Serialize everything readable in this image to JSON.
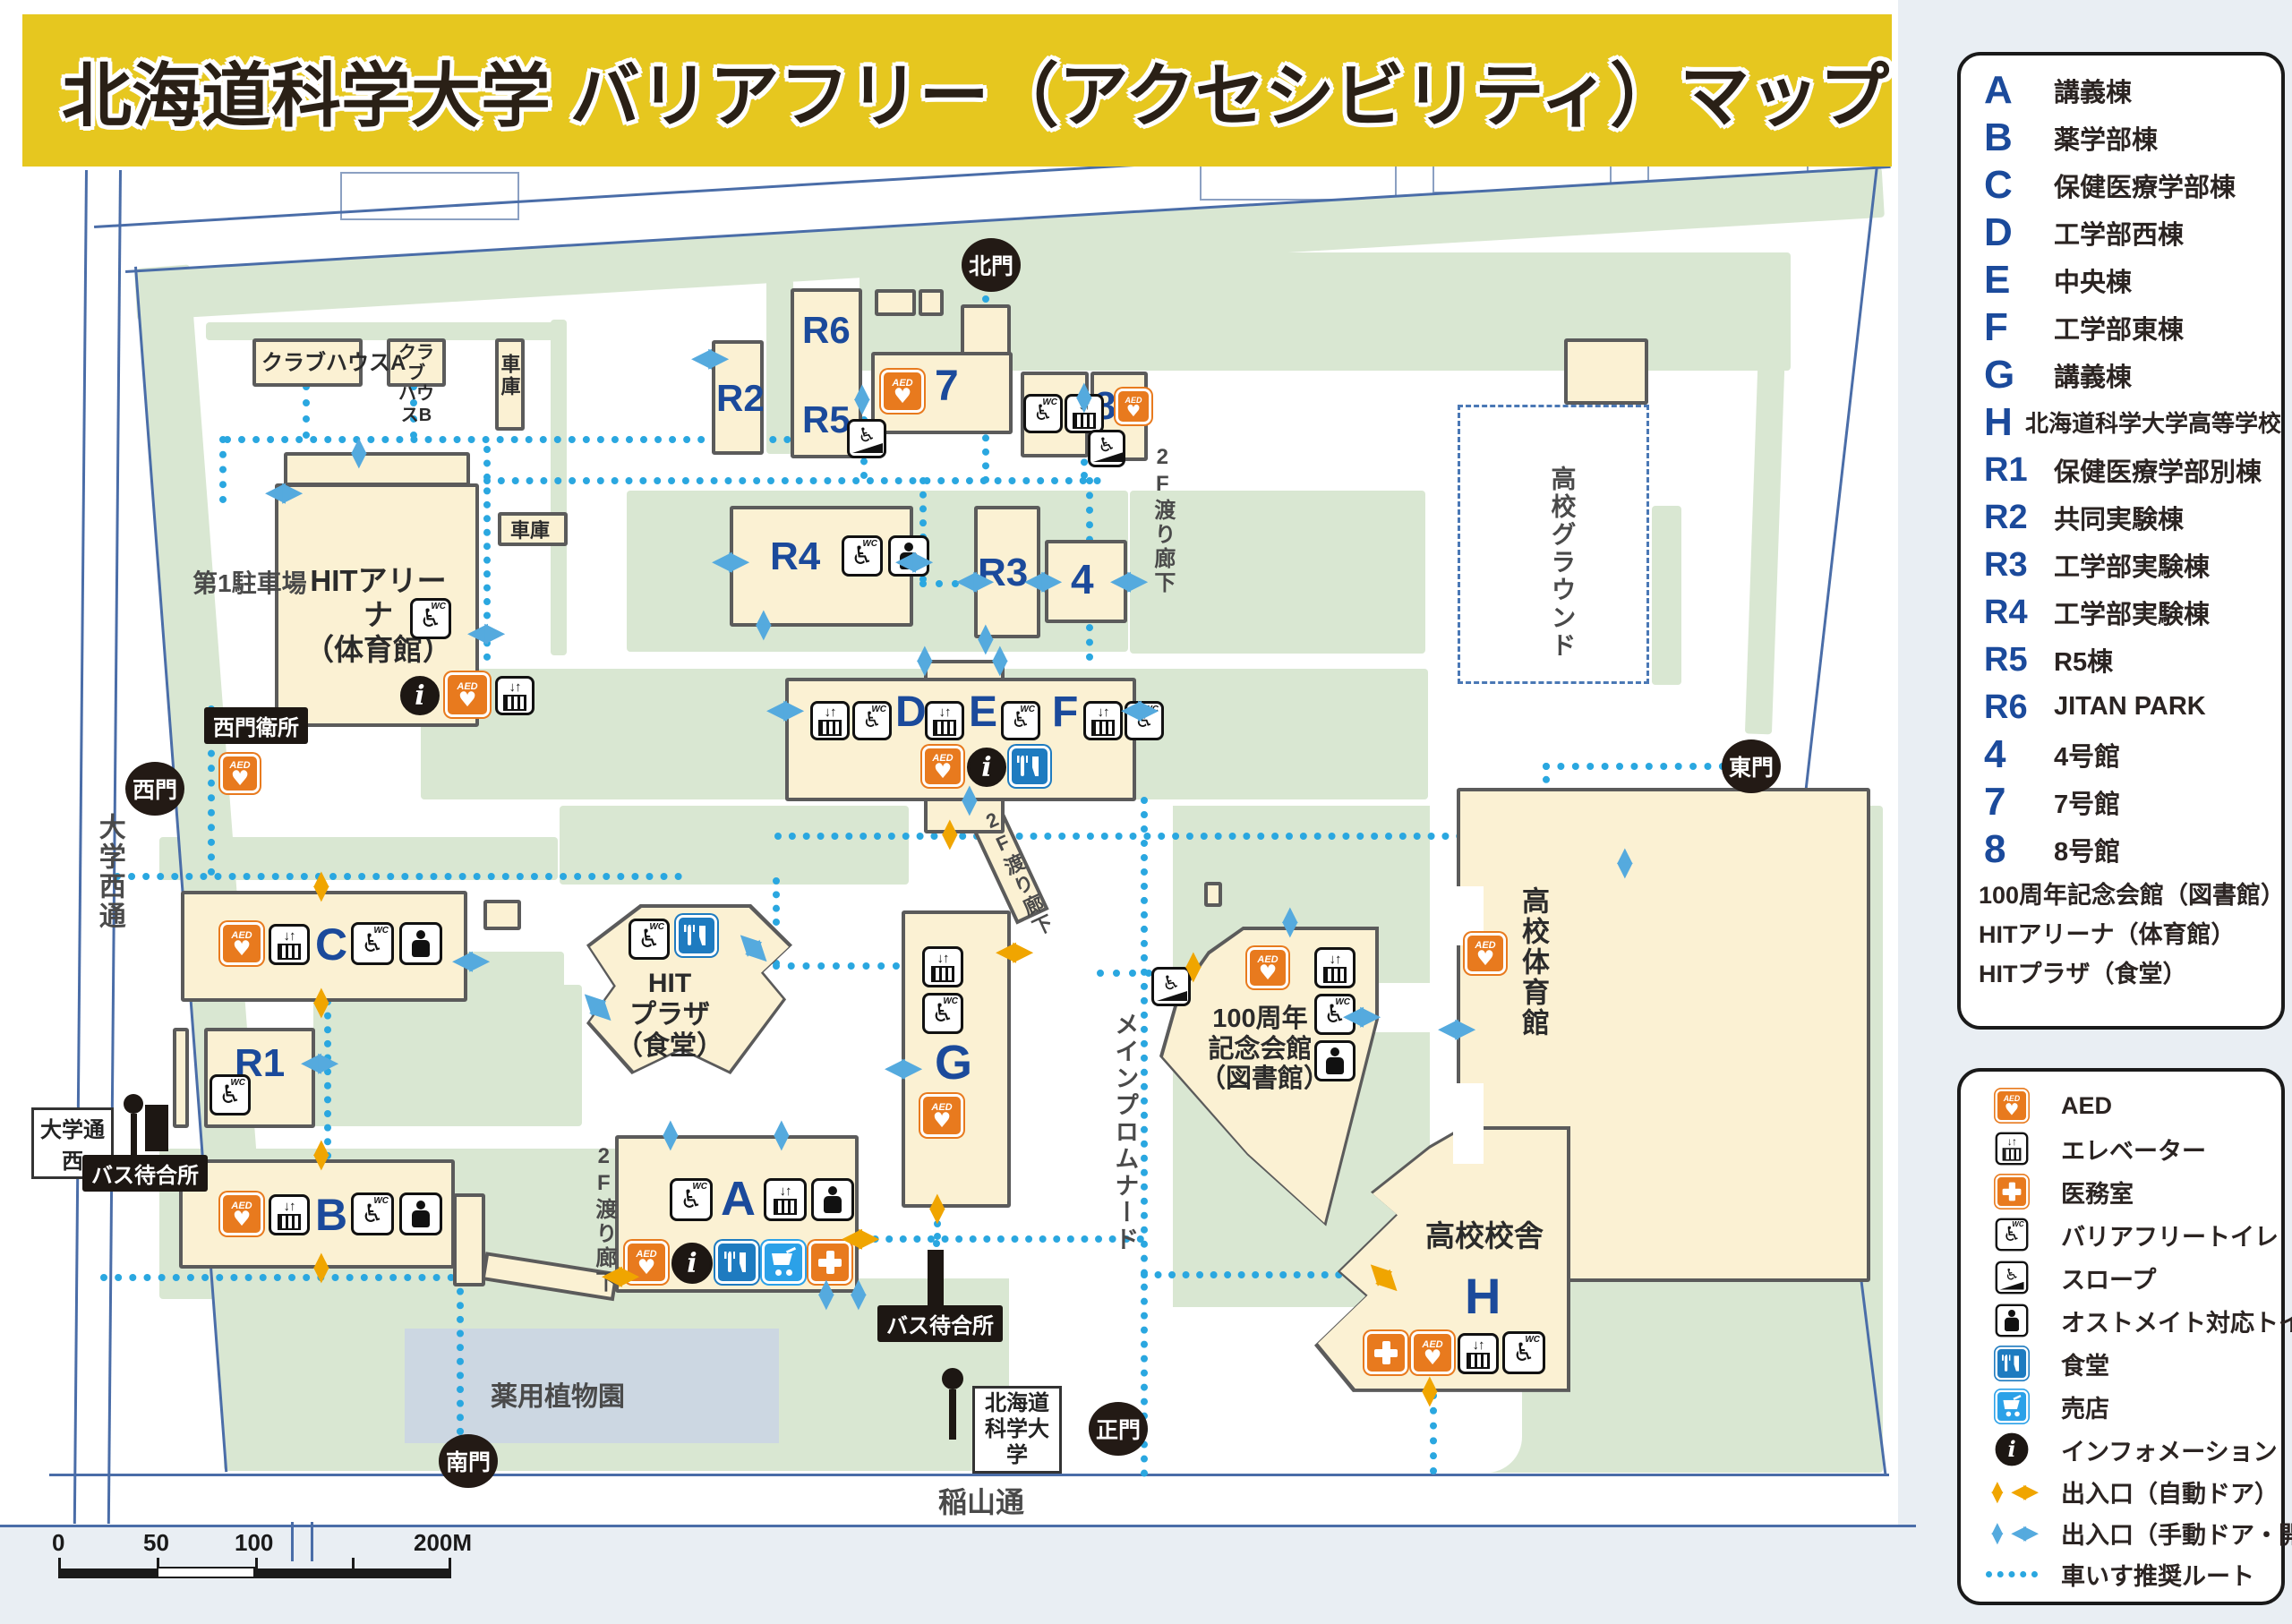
{
  "title": "北海道科学大学 バリアフリー（アクセシビリティ）マップ",
  "building_legend": {
    "items": [
      {
        "code": "A",
        "label": "講義棟"
      },
      {
        "code": "B",
        "label": "薬学部棟"
      },
      {
        "code": "C",
        "label": "保健医療学部棟"
      },
      {
        "code": "D",
        "label": "工学部西棟"
      },
      {
        "code": "E",
        "label": "中央棟"
      },
      {
        "code": "F",
        "label": "工学部東棟"
      },
      {
        "code": "G",
        "label": "講義棟"
      },
      {
        "code": "H",
        "label": "北海道科学大学高等学校"
      },
      {
        "code": "R1",
        "label": "保健医療学部別棟"
      },
      {
        "code": "R2",
        "label": "共同実験棟"
      },
      {
        "code": "R3",
        "label": "工学部実験棟"
      },
      {
        "code": "R4",
        "label": "工学部実験棟"
      },
      {
        "code": "R5",
        "label": "R5棟"
      },
      {
        "code": "R6",
        "label": "JITAN PARK"
      },
      {
        "code": "4",
        "label": "4号館"
      },
      {
        "code": "7",
        "label": "7号館"
      },
      {
        "code": "8",
        "label": "8号館"
      },
      {
        "code": "",
        "label": "100周年記念会館（図書館）"
      },
      {
        "code": "",
        "label": "HITアリーナ（体育館）"
      },
      {
        "code": "",
        "label": "HITプラザ（食堂）"
      }
    ]
  },
  "facility_legend": {
    "items": [
      {
        "icon": "aed-icon",
        "label": "AED"
      },
      {
        "icon": "elevator-icon",
        "label": "エレベーター"
      },
      {
        "icon": "infirmary-icon",
        "label": "医務室"
      },
      {
        "icon": "accessible-toilet-icon",
        "label": "バリアフリートイレ"
      },
      {
        "icon": "slope-icon",
        "label": "スロープ"
      },
      {
        "icon": "ostomate-icon",
        "label": "オストメイト対応トイレ"
      },
      {
        "icon": "cafeteria-icon",
        "label": "食堂"
      },
      {
        "icon": "shop-icon",
        "label": "売店"
      },
      {
        "icon": "information-icon",
        "label": "インフォメーション"
      },
      {
        "icon": "entrance-auto-icon",
        "label": "出入口（自動ドア）"
      },
      {
        "icon": "entrance-manual-icon",
        "label": "出入口（手動ドア・開き戸）"
      },
      {
        "icon": "wheelchair-route-icon",
        "label": "車いす推奨ルート"
      }
    ]
  },
  "map": {
    "gates": {
      "north": "北門",
      "west": "西門",
      "south": "南門",
      "east": "東門",
      "main": "正門"
    },
    "buildings": {
      "a": "A",
      "b": "B",
      "c": "C",
      "d": "D",
      "e": "E",
      "f": "F",
      "g": "G",
      "h": "H",
      "r1": "R1",
      "r2": "R2",
      "r3": "R3",
      "r4": "R4",
      "r5": "R5",
      "r6": "R6",
      "n4": "4",
      "n7": "7",
      "n8": "8"
    },
    "labels": {
      "clubhouse_a": "クラブハウスA",
      "clubhouse_b1": "クラブ",
      "clubhouse_b2": "ハウスB",
      "garage": "車庫",
      "parking1": "第1駐車場",
      "west_gate_office": "西門衛所",
      "univ_west_st": "大学西通",
      "bus_stop_sign": "大学通西",
      "bus_shelter": "バス待合所",
      "herb_garden": "薬用植物園",
      "south_st": "稲山通",
      "promenade": "メインプロムナード",
      "hs_ground": "高校グラウンド",
      "hs_gym": "高校体育館",
      "hs_school": "高校校舎",
      "corridor2f": "2F渡り廊下",
      "bus_sign1": "北海道",
      "bus_sign2": "科学大学",
      "hit_arena1": "HITアリーナ",
      "hit_arena2": "（体育館）",
      "hit_plaza1": "HIT",
      "hit_plaza2": "プラザ",
      "hit_plaza3": "（食堂）",
      "cent1": "100周年",
      "cent2": "記念会館",
      "cent3": "（図書館）"
    }
  },
  "scale_bar": {
    "t0": "0",
    "t50": "50",
    "t100": "100",
    "t200": "200M"
  },
  "colors": {
    "accent_yellow": "#e6c71f",
    "building_fill": "#fbf1d3",
    "lawn_green": "#d9e7d2",
    "route_blue": "#2aa7e0",
    "letter_blue": "#1b4a9b",
    "aed_orange": "#e87a1e",
    "entrance_orange": "#f0a500",
    "entrance_blue": "#55aade"
  }
}
